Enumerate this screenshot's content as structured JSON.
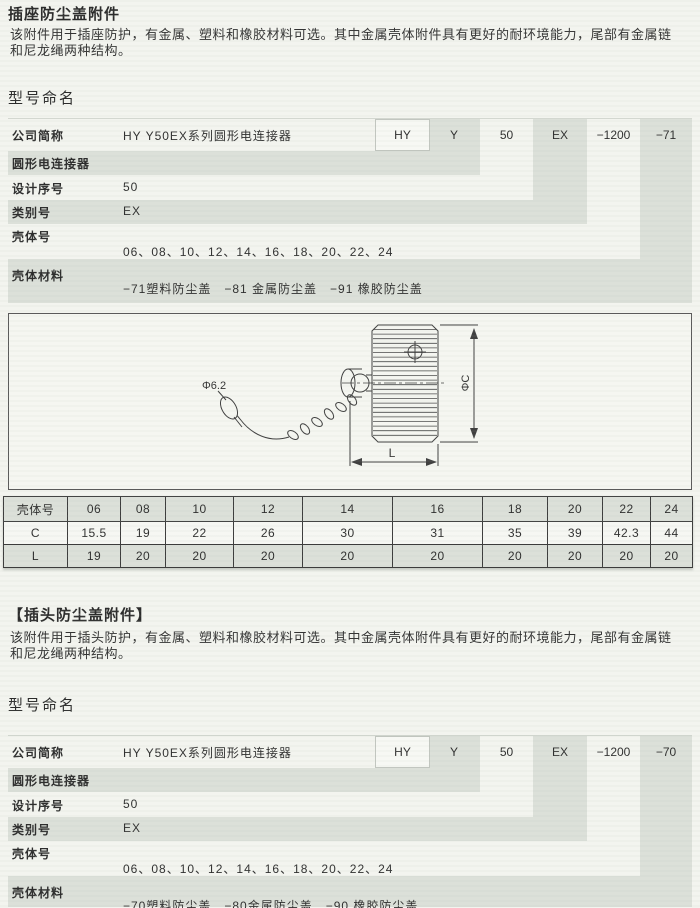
{
  "page": {
    "colors": {
      "band": "#dce0d9",
      "paper": "#f3f4ef",
      "table_line": "#3c3c3c"
    },
    "sections": [
      {
        "title": "插座防尘盖附件",
        "description": "该附件用于插座防护，有金属、塑料和橡胶材料可选。其中金属壳体附件具有更好的耐环境能力，尾部有金属链和尼龙绳两种结构。",
        "naming_heading": "型号命名",
        "naming": {
          "codes": [
            "HY",
            "Y",
            "50",
            "EX",
            "−1200",
            "−71"
          ],
          "rows": [
            {
              "label": "公司简称",
              "value": "HY Y50EX系列圆形电连接器"
            },
            {
              "label": "圆形电连接器",
              "value": ""
            },
            {
              "label": "设计序号",
              "value": "50"
            },
            {
              "label": "类别号",
              "value": "EX"
            },
            {
              "label": "壳体号",
              "value": "06、08、10、12、14、16、18、20、22、24"
            },
            {
              "label": "壳体材料",
              "value": "−71塑料防尘盖　−81 金属防尘盖　−91 橡胶防尘盖"
            }
          ]
        }
      },
      {
        "title": "【插头防尘盖附件】",
        "description": "该附件用于插头防护，有金属、塑料和橡胶材料可选。其中金属壳体附件具有更好的耐环境能力，尾部有金属链和尼龙绳两种结构。",
        "naming_heading": "型号命名",
        "naming": {
          "codes": [
            "HY",
            "Y",
            "50",
            "EX",
            "−1200",
            "−70"
          ],
          "rows": [
            {
              "label": "公司简称",
              "value": "HY Y50EX系列圆形电连接器"
            },
            {
              "label": "圆形电连接器",
              "value": ""
            },
            {
              "label": "设计序号",
              "value": "50"
            },
            {
              "label": "类别号",
              "value": "EX"
            },
            {
              "label": "壳体号",
              "value": "06、08、10、12、14、16、18、20、22、24"
            },
            {
              "label": "壳体材料",
              "value": "−70塑料防尘盖　−80金属防尘盖　−90 橡胶防尘盖"
            }
          ]
        }
      }
    ],
    "drawing_labels": {
      "hole_dia": "Φ6.2",
      "dia": "ΦC",
      "length": "L"
    },
    "dim_table": {
      "type": "table",
      "corner_label": "壳体号",
      "columns": [
        "06",
        "08",
        "10",
        "12",
        "14",
        "16",
        "18",
        "20",
        "22",
        "24"
      ],
      "rows": [
        {
          "label": "C",
          "values": [
            "15.5",
            "19",
            "22",
            "26",
            "30",
            "31",
            "35",
            "39",
            "42.3",
            "44"
          ]
        },
        {
          "label": "L",
          "values": [
            "19",
            "20",
            "20",
            "20",
            "20",
            "20",
            "20",
            "20",
            "20",
            "20"
          ]
        }
      ]
    }
  }
}
